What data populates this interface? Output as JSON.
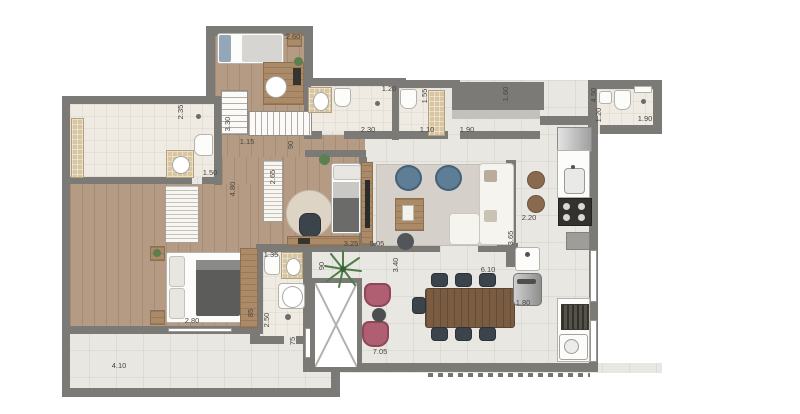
{
  "plan": {
    "type": "apartment-floor-plan",
    "shaft_marker": "x-cross",
    "colors": {
      "wall": "#7b7a77",
      "wood_floor": "#b59b84",
      "tile_floor": "#e9e7e1",
      "bath_floor": "#efeae2",
      "vanity_beige": "#d8c6a2",
      "accent_blue": "#5d7e95",
      "accent_pink": "#b05f72",
      "dining_wood": "#7a5c42"
    },
    "dimensions": [
      {
        "id": "bedroom1-width",
        "text": "2.60",
        "orientation": "h"
      },
      {
        "id": "bathroom1-depth",
        "text": "2.35",
        "orientation": "v"
      },
      {
        "id": "staircase-run",
        "text": "3.30",
        "orientation": "v"
      },
      {
        "id": "corridor-width",
        "text": "1.15",
        "orientation": "h"
      },
      {
        "id": "corridor-door",
        "text": "90",
        "orientation": "v"
      },
      {
        "id": "bathroom1-width",
        "text": "1.50",
        "orientation": "h"
      },
      {
        "id": "hall-length",
        "text": "4.80",
        "orientation": "v"
      },
      {
        "id": "bedroom2-depth",
        "text": "2.65",
        "orientation": "v"
      },
      {
        "id": "bathroom2-width",
        "text": "1.35",
        "orientation": "h"
      },
      {
        "id": "master-bedroom-width",
        "text": "2.80",
        "orientation": "h"
      },
      {
        "id": "wardrobe-depth",
        "text": "85",
        "orientation": "v"
      },
      {
        "id": "bathroom2-depth",
        "text": "2.50",
        "orientation": "v"
      },
      {
        "id": "bathroom2-door",
        "text": "75",
        "orientation": "v"
      },
      {
        "id": "terrace-left-width",
        "text": "4.10",
        "orientation": "h"
      },
      {
        "id": "bedroom2-width",
        "text": "3.25",
        "orientation": "h"
      },
      {
        "id": "living-width",
        "text": "5.05",
        "orientation": "h"
      },
      {
        "id": "suite1-bath-shower",
        "text": "1.20",
        "orientation": "h"
      },
      {
        "id": "lavatory-depth",
        "text": "1.55",
        "orientation": "v"
      },
      {
        "id": "lavatory-width",
        "text": "1.10",
        "orientation": "h"
      },
      {
        "id": "storage-width",
        "text": "1.90",
        "orientation": "h"
      },
      {
        "id": "suite1-bath-width",
        "text": "2.30",
        "orientation": "h"
      },
      {
        "id": "entry-width",
        "text": "1.60",
        "orientation": "v"
      },
      {
        "id": "kitchen-length",
        "text": "4.50",
        "orientation": "v"
      },
      {
        "id": "service-bath-depth",
        "text": "1.20",
        "orientation": "v"
      },
      {
        "id": "service-bath-width",
        "text": "1.90",
        "orientation": "h"
      },
      {
        "id": "kitchen-width",
        "text": "2.20",
        "orientation": "h"
      },
      {
        "id": "living-depth",
        "text": "3.65",
        "orientation": "v"
      },
      {
        "id": "terrace-depth",
        "text": "3.40",
        "orientation": "v"
      },
      {
        "id": "terrace-upper-width",
        "text": "6.10",
        "orientation": "h"
      },
      {
        "id": "grill-bench",
        "text": "1.80",
        "orientation": "h"
      },
      {
        "id": "terrace-width",
        "text": "7.05",
        "orientation": "h"
      },
      {
        "id": "shaft-door",
        "text": "90",
        "orientation": "v"
      }
    ]
  }
}
